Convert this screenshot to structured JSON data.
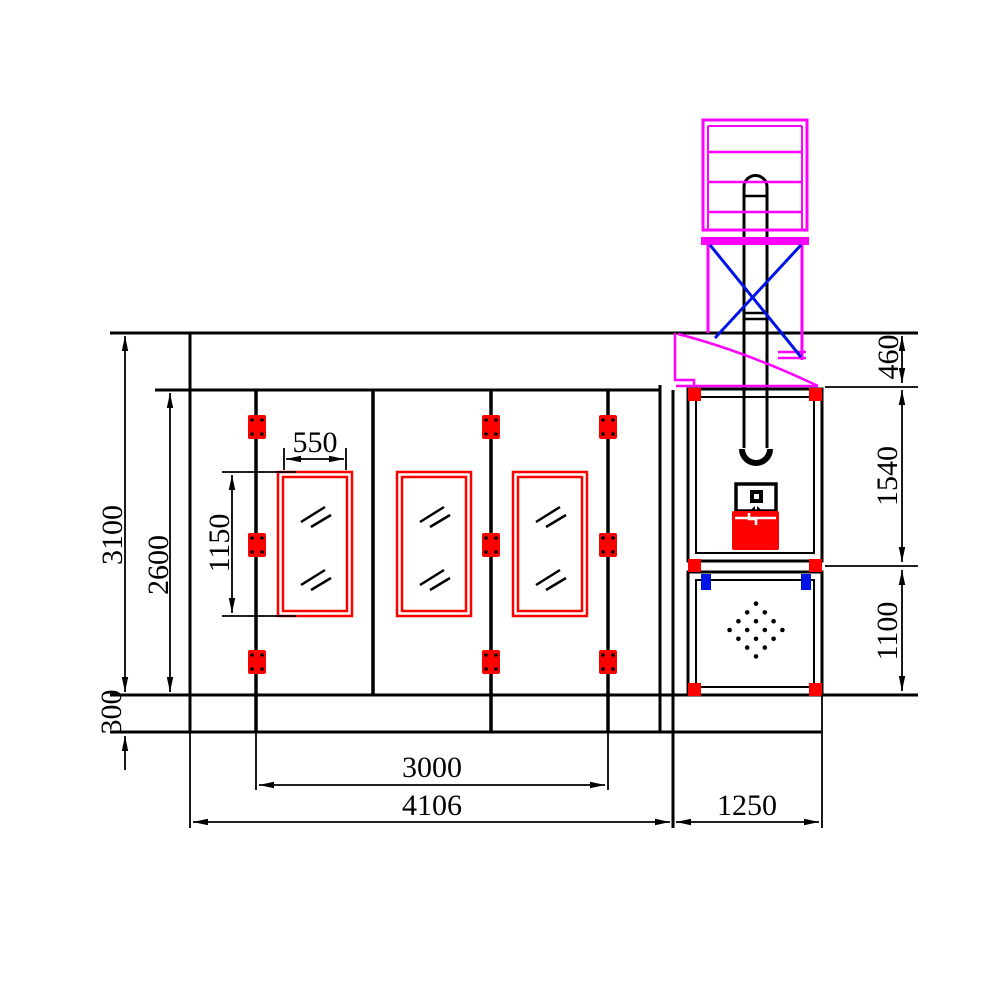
{
  "drawing": {
    "kind": "technical-elevation",
    "subject": "spray-booth front elevation with exhaust stack and fan cabinet"
  },
  "colors": {
    "line": "#000000",
    "red": "#ff0000",
    "magenta": "#ff00ff",
    "blue": "#0014e6",
    "paper": "#ffffff"
  },
  "dims": {
    "total_height": "3100",
    "door_opening_height": "2600",
    "window_height": "1150",
    "window_width": "550",
    "base_height": "300",
    "door_span_width": "3000",
    "booth_total_width": "4106",
    "machine_bay_width": "1250",
    "duct_transition_height": "460",
    "fan_section_height": "1540",
    "filter_section_height": "1100"
  }
}
